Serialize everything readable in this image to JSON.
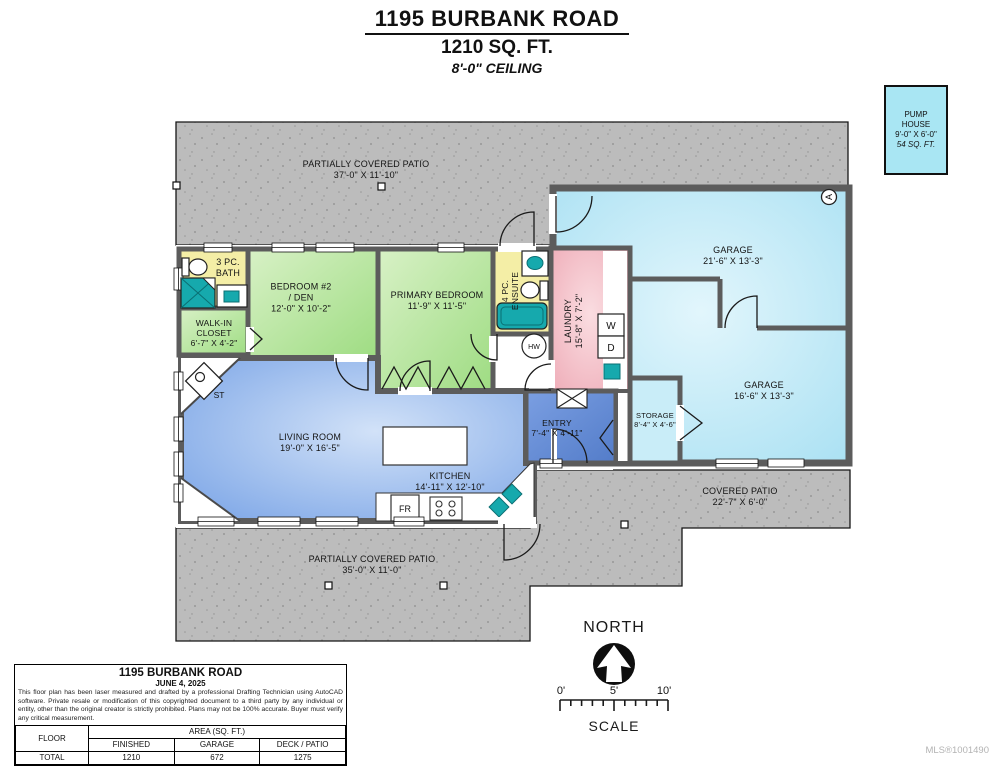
{
  "header": {
    "address": "1195 BURBANK ROAD",
    "area": "1210 SQ. FT.",
    "ceiling": "8'-0\" CEILING"
  },
  "pump_house": {
    "line1": "PUMP",
    "line2": "HOUSE",
    "dims": "9'-0\" X 6'-0\"",
    "area": "54 SQ. FT."
  },
  "rooms": {
    "patio_top": {
      "name": "PARTIALLY COVERED PATIO",
      "dims": "37'-0\" X 11'-10\""
    },
    "garage_upper": {
      "name": "GARAGE",
      "dims": "21'-6\" X 13'-3\""
    },
    "garage_lower": {
      "name": "GARAGE",
      "dims": "16'-6\" X 13'-3\""
    },
    "storage": {
      "name": "STORAGE",
      "dims": "8'-4\" X 4'-6\""
    },
    "bath": {
      "line1": "3 PC.",
      "line2": "BATH"
    },
    "walk_in_closet": {
      "line1": "WALK-IN",
      "line2": "CLOSET",
      "dims": "6'-7\" X 4'-2\""
    },
    "bedroom2": {
      "line1": "BEDROOM #2",
      "line2": "/ DEN",
      "dims": "12'-0\" X 10'-2\""
    },
    "primary_bedroom": {
      "name": "PRIMARY BEDROOM",
      "dims": "11'-9\" X 11'-5\""
    },
    "ensuite": {
      "line1": "4 PC.",
      "line2": "ENSUITE"
    },
    "laundry": {
      "name": "LAUNDRY",
      "dims": "15'-8\" X 7'-2\""
    },
    "living_room": {
      "name": "LIVING ROOM",
      "dims": "19'-0\" X 16'-5\""
    },
    "kitchen": {
      "name": "KITCHEN",
      "dims": "14'-11\" X 12'-10\""
    },
    "entry": {
      "name": "ENTRY",
      "dims": "7'-4\" X 4'-11\""
    },
    "covered_patio": {
      "name": "COVERED PATIO",
      "dims": "22'-7\" X 6'-0\""
    },
    "patio_bottom": {
      "name": "PARTIALLY COVERED PATIO",
      "dims": "35'-0\" X 11'-0\""
    }
  },
  "fixtures": {
    "washer": "W",
    "dryer": "D",
    "hot_water": "HW",
    "wood_stove": "ST",
    "fridge": "FR",
    "attic_access": "A"
  },
  "compass": {
    "label": "NORTH"
  },
  "scale_bar": {
    "tick0": "0'",
    "tick5": "5'",
    "tick10": "10'",
    "label": "SCALE"
  },
  "info_box": {
    "title": "1195 BURBANK ROAD",
    "date": "JUNE 4, 2025",
    "disclaimer": "This floor plan has been laser measured and drafted by a professional Drafting Technician using AutoCAD software. Private resale or modification of this copyrighted document to a third party by any individual or entity, other than the original creator is strictly prohibited. Plans may not be 100% accurate.  Buyer must verify any critical measurement.",
    "table": {
      "floor_header": "FLOOR",
      "area_header": "AREA (SQ. FT.)",
      "col_finished": "FINISHED",
      "col_garage": "GARAGE",
      "col_deck": "DECK / PATIO",
      "total_label": "TOTAL",
      "total_finished": "1210",
      "total_garage": "672",
      "total_deck": "1275"
    }
  },
  "watermark": "MLS®1001490",
  "colors": {
    "patio_gray": "#bcbcbc",
    "wall_gray": "#5c5c5c",
    "room_green": "#b5e39c",
    "room_blue": "#84abe8",
    "room_cyan": "#b3e5f4",
    "room_pink": "#f2b6bf",
    "room_yellow": "#f4eea6",
    "fixture_teal": "#16a9ad"
  }
}
